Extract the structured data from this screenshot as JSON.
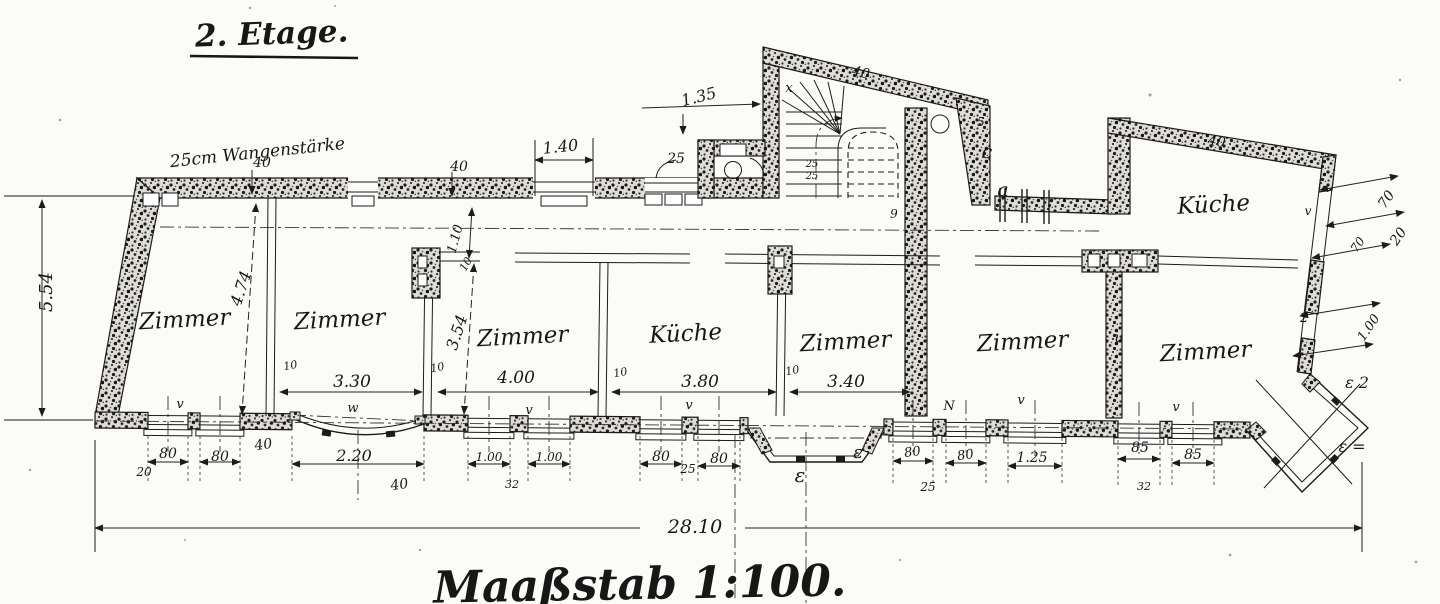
{
  "title": "2. Etage.",
  "scale_label": "Maaßstab 1:100.",
  "wall_note": "25cm Wangenstärke",
  "overall_width": "28.10",
  "rooms": {
    "room1": "Zimmer",
    "room2": "Zimmer",
    "room3": "Zimmer",
    "kitchen_main": "Küche",
    "room4": "Zimmer",
    "room5": "Zimmer",
    "room6": "Zimmer",
    "kitchen_upper": "Küche"
  },
  "dims": {
    "height_left": "5.54",
    "depth_room1": "4.74",
    "depth_room3": "3.54",
    "corridor_depth": "1.10",
    "top_window": "1.40",
    "stair_width": "1.35",
    "width_room2": "3.30",
    "width_room3": "4.00",
    "width_kitchen": "3.80",
    "width_room4": "3.40",
    "wall10_a": "10",
    "wall10_b": "10",
    "wall10_c": "10",
    "wall10_d": "10",
    "wall10_e": "10",
    "wall40_a": "40",
    "wall40_b": "40",
    "wall40_c": "40",
    "wall40_d": "40",
    "wall40_e": "40",
    "wall40_f": "40",
    "wall25": "25",
    "stair_tread_a": "25",
    "stair_tread_b": "25",
    "win80_a": "80",
    "win20": "20",
    "win80_b": "80",
    "bay_width": "2.20",
    "win100_a": "1.00",
    "pier32_a": "32",
    "win100_b": "1.00",
    "win80_c": "80",
    "pier25_a": "25",
    "win80_d": "80",
    "win80_e": "80",
    "pier25_b": "25",
    "win80_f": "80",
    "win125": "1.25",
    "win85_a": "85",
    "pier32_b": "32",
    "win85_b": "85",
    "right70_a": "70",
    "right20": "20",
    "right70_b": "70",
    "right100": "1.00",
    "right2": "2"
  },
  "marks": {
    "a": "a",
    "c": "c",
    "x": "x",
    "n5": "5",
    "n9": "9",
    "eps1": "ε",
    "eps2": "ε",
    "eps3": "ε 2",
    "eps4": "ε =",
    "v1": "v",
    "v2": "w",
    "v3": "v",
    "v4": "v",
    "v5": "N",
    "v6": "v",
    "v7": "v",
    "u": "u",
    "w_right": "v"
  }
}
